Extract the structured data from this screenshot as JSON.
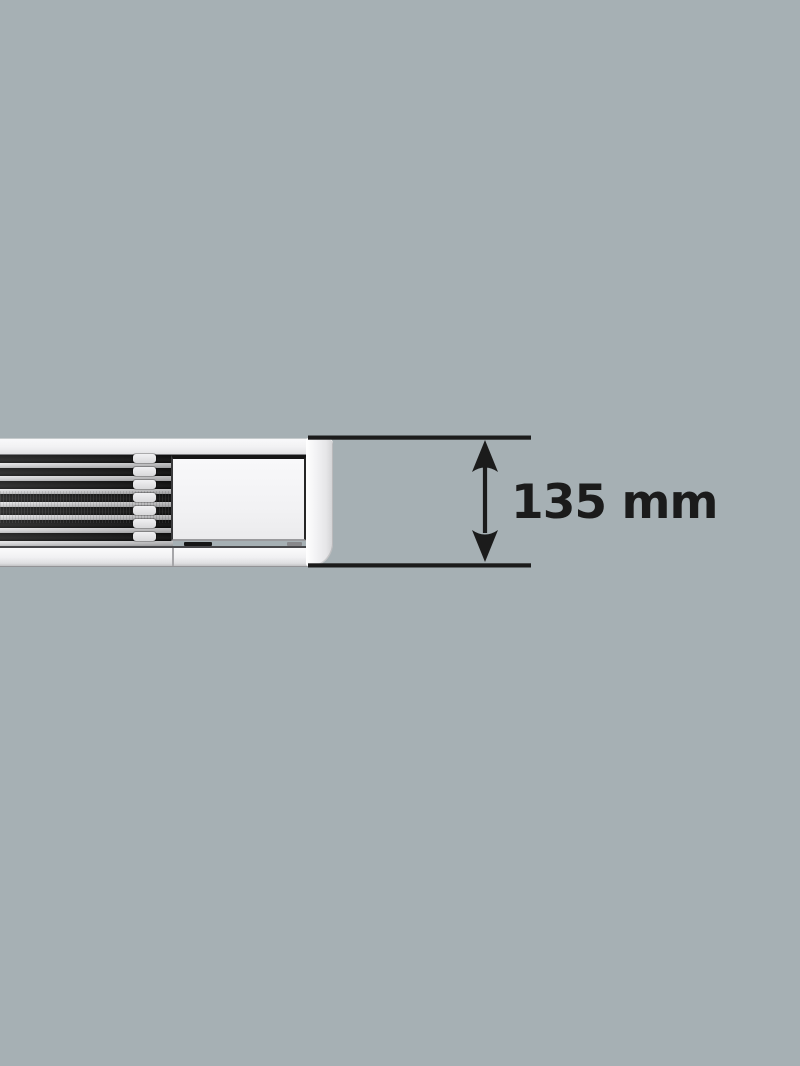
{
  "figure": {
    "description": "Side profile of a slim white louvered unit, cut off at the left edge, with a vertical height dimension marked at its right end"
  },
  "annotation": {
    "label": "135 mm",
    "value": "135",
    "unit": "mm"
  },
  "colors": {
    "background": "#a6b0b4",
    "ink": "#1b1b1b",
    "unit_body": "#f0f0f2",
    "slat_light": "#d3d3d5",
    "louver_dark": "#141414",
    "panel_white": "#f5f5f7",
    "end_cap": "#ececee"
  }
}
